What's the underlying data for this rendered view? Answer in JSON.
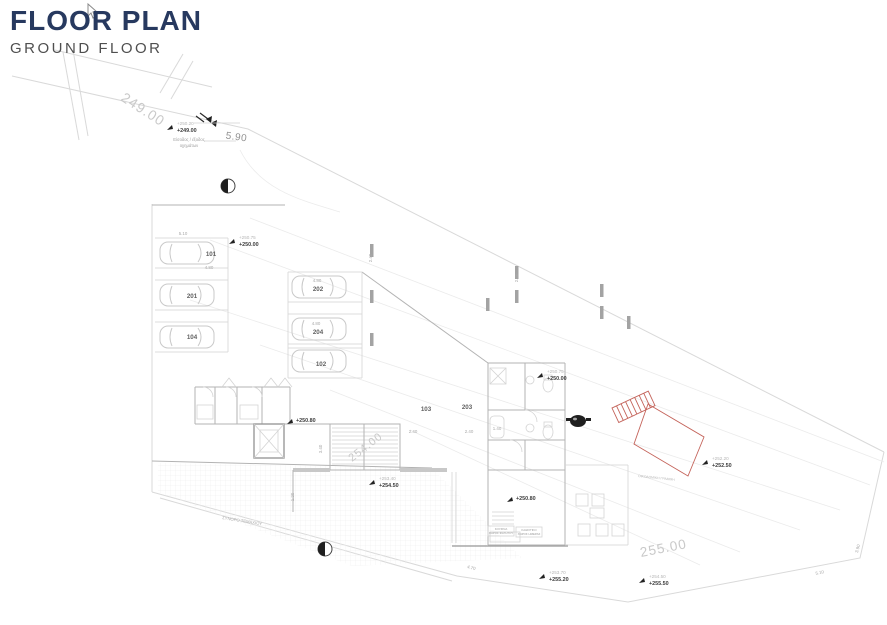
{
  "header": {
    "title": "FLOOR PLAN",
    "subtitle": "GROUND FLOOR"
  },
  "colors": {
    "title": "#27395f",
    "subtitle": "#4f4f4f",
    "contour_label": "#c9c9c9",
    "wall": "#b3b3b3",
    "boundary": "#d9d9d9",
    "red_stair": "#c4635a",
    "spot_top": "#b5b5b5",
    "spot_bottom": "#3c3c3c",
    "symbol_black": "#1f1f1f"
  },
  "contours": [
    {
      "label": "249.00"
    },
    {
      "label": "254.00"
    },
    {
      "label": "255.00"
    }
  ],
  "spot_levels": [
    {
      "top": "+250.20",
      "bottom": "+249.00"
    },
    {
      "top": "+250.75",
      "bottom": "+250.00"
    },
    {
      "top": "+250.75",
      "bottom": "+250.00"
    },
    {
      "top": "+253.40",
      "bottom": "+254.50"
    },
    {
      "top": "+252.20",
      "bottom": "+252.50"
    },
    {
      "top": "+253.70",
      "bottom": "+255.20"
    },
    {
      "top": "+254.50",
      "bottom": "+255.50"
    }
  ],
  "single_levels": [
    {
      "value": "+250.80"
    },
    {
      "value": "+250.80"
    }
  ],
  "units": [
    {
      "number": "101"
    },
    {
      "number": "201"
    },
    {
      "number": "104"
    },
    {
      "number": "202"
    },
    {
      "number": "204"
    },
    {
      "number": "102"
    },
    {
      "number": "103"
    },
    {
      "number": "203"
    }
  ],
  "dimensions": [
    {
      "value": "5.90"
    },
    {
      "value": "5.10"
    },
    {
      "value": "4.80"
    },
    {
      "value": "4.80"
    },
    {
      "value": "4.80"
    },
    {
      "value": "2.40"
    },
    {
      "value": "2.40"
    },
    {
      "value": "2.40"
    },
    {
      "value": "2.40"
    },
    {
      "value": "1.40"
    },
    {
      "value": "1.20"
    },
    {
      "value": "3.40"
    },
    {
      "value": "4.70"
    },
    {
      "value": "5.10"
    },
    {
      "value": "3.90"
    }
  ],
  "annotations": {
    "vehicle_access_line1": "Είσοδος / έξοδος",
    "vehicle_access_line2": "οχημάτων",
    "plot_boundary": "ΣΥΝΟΡΟ ΤΕΜΑΧΙΟΥ",
    "building_line": "ΟΙΚΟΔΟΜΙΚΗ ΓΡΑΜΜΗ",
    "kitchen_line1": "ΚΟΥΖΙΝΑ",
    "kitchen_line2": "ΧΩΡΟΣ ΦΑΓΗΤΟΥ",
    "living_line1": "ΚΑΘΙΣΤΙΚΟ",
    "living_line2": "ΧΩΡΟΣ ΗΜΕΡΑΣ"
  }
}
